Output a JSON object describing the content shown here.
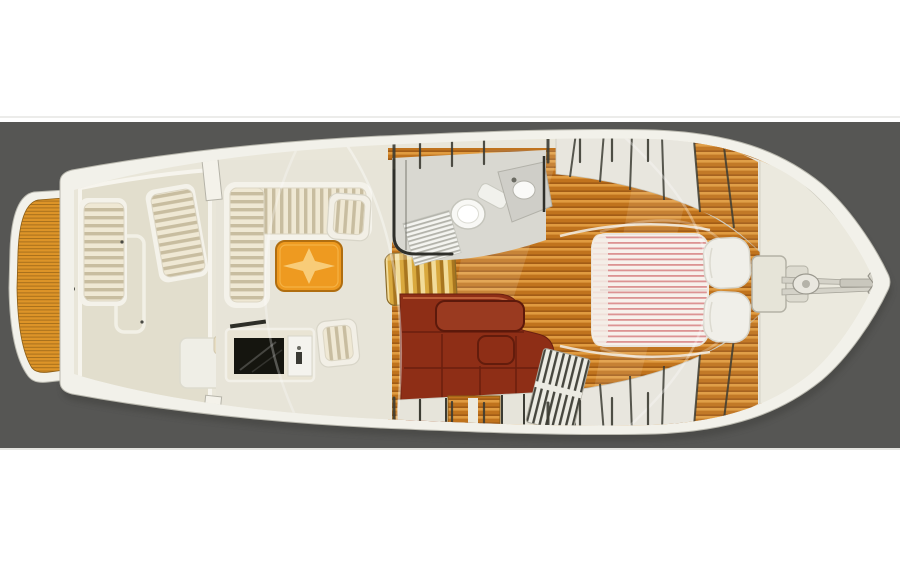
{
  "scene": {
    "type": "yacht interior floor plan illustration",
    "orientation": "top-down plan view, bow pointing right, stern with swim platform at left",
    "text_visible": "none"
  },
  "colors": {
    "bg_gray": "#565654",
    "band_white": "#ffffff",
    "rule_light": "#ececea",
    "hull_white": "#f2f1ea",
    "hull_stroke": "#b9b8ae",
    "deck_cream": "#e9e6d9",
    "cockpit_floor": "#e2decd",
    "salon_floor": "#e7e4d8",
    "coaming_white": "#f6f4ed",
    "teak_base": "#dd9428",
    "teak_dark": "#a8701c",
    "sole_base": "#c0731d",
    "sole_light": "#e09b40",
    "sole_dark": "#8f4d10",
    "cushion_light": "#efe8d4",
    "cushion_dark": "#c8bda0",
    "stairs_light": "#f2dc9a",
    "stairs_mid": "#d9a93e",
    "stairs_dark": "#a8761f",
    "table_orange": "#ee9a20",
    "table_border": "#b06e10",
    "star_gold": "#f8cf7d",
    "maroon": "#8e2e16",
    "maroon_dark": "#5c190b",
    "maroon_hi": "#c96a42",
    "mattress_base": "#f7f1ec",
    "mattress_stripe": "#dc9393",
    "pillow": "#f0efe9",
    "screen_dark": "#15150f",
    "locker_fill": "#e8e6de",
    "divider_dark": "#3c3c34",
    "head_floor": "#d9d8d1",
    "fixture_white": "#f8f8f5",
    "grate_dark": "#46463e",
    "metal": "#d4d2c8"
  },
  "boat": {
    "sections": [
      {
        "name": "swim-platform",
        "surface": "teak planking"
      },
      {
        "name": "cockpit",
        "features": [
          "bench-seat-port",
          "bench-seat-starboard",
          "sole-hatch",
          "transom-module",
          "teak-caprails"
        ]
      },
      {
        "name": "salon",
        "features": [
          "l-shaped-sofa",
          "armchair",
          "hi-lo-table-with-star-inlay",
          "tv-cabinet",
          "side-chair",
          "companionway-stairs"
        ]
      },
      {
        "name": "head",
        "features": [
          "toilet",
          "vanity-sink",
          "striped-floor-mat"
        ]
      },
      {
        "name": "galley-dinette",
        "features": [
          "maroon-settee",
          "dinette-table",
          "stove-grate",
          "under-sole-lockers",
          "teak-cabin-sole"
        ]
      },
      {
        "name": "forward-stateroom",
        "features": [
          "island-berth-striped-mattress",
          "two-pillows",
          "hull-side-lockers",
          "teak-wedges"
        ]
      },
      {
        "name": "foredeck",
        "features": [
          "forward-hatch",
          "windlass",
          "anchor",
          "bow-pulpit",
          "teak-sheer-margins"
        ]
      }
    ]
  }
}
